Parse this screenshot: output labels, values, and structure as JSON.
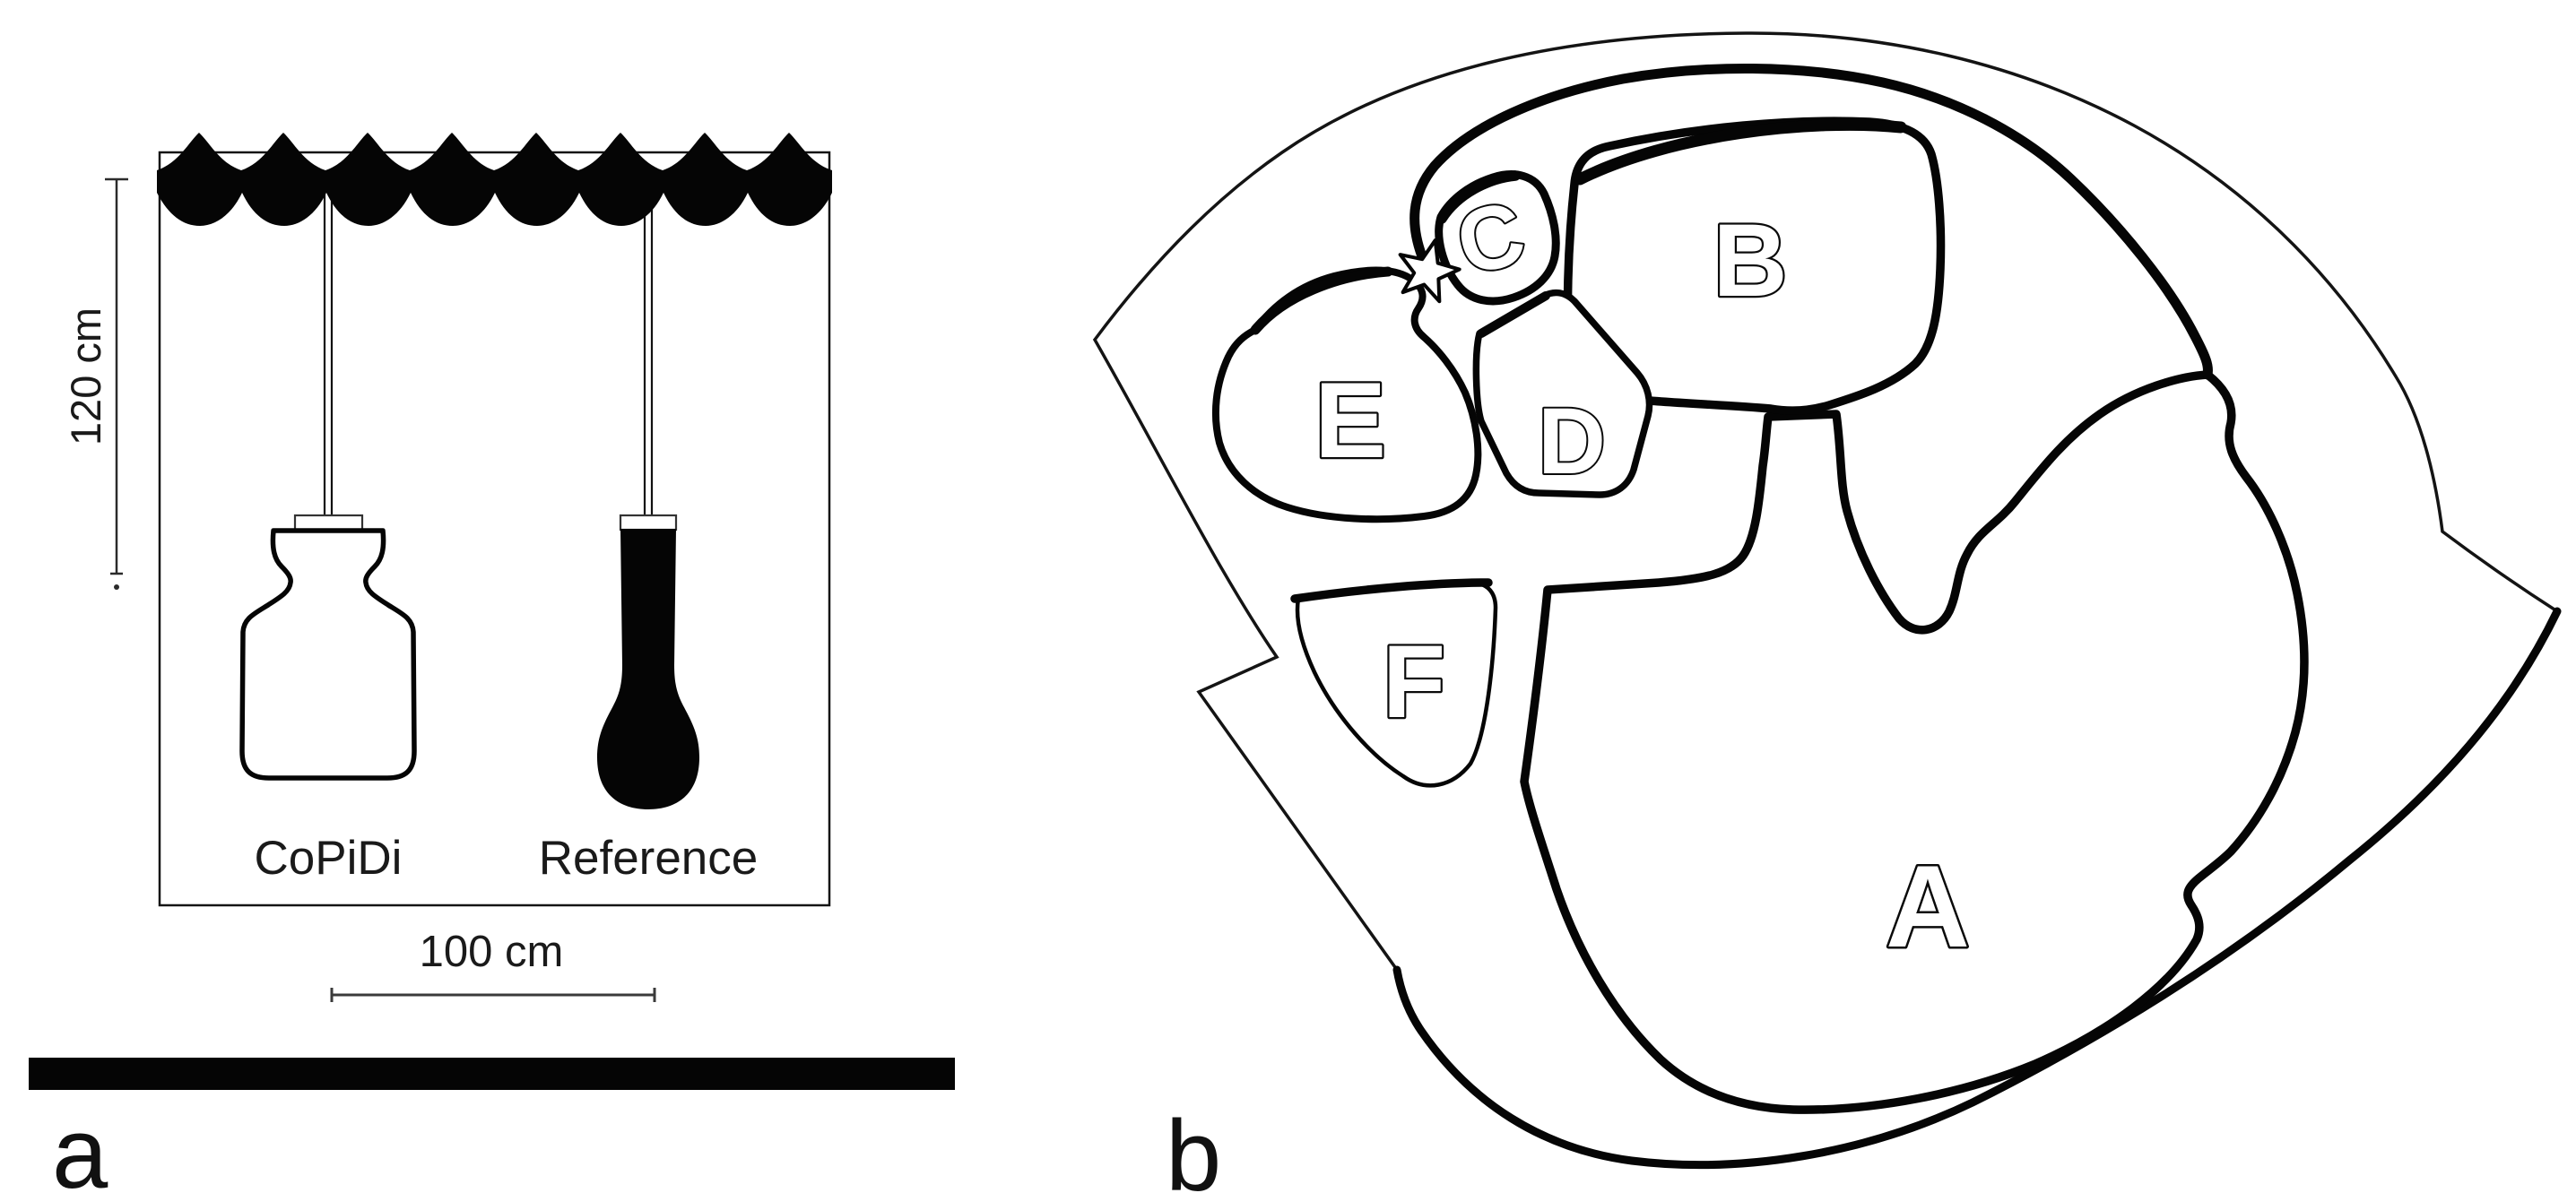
{
  "figure": {
    "panel_a": {
      "label": "a",
      "depth_label": "120 cm",
      "scale_label": "100 cm",
      "device_left_label": "CoPiDi",
      "device_right_label": "Reference"
    },
    "panel_b": {
      "label": "b",
      "regions": [
        "A",
        "B",
        "C",
        "D",
        "E",
        "F"
      ],
      "marker": "star"
    }
  },
  "colors": {
    "ink": "#000000",
    "background": "#ffffff"
  }
}
